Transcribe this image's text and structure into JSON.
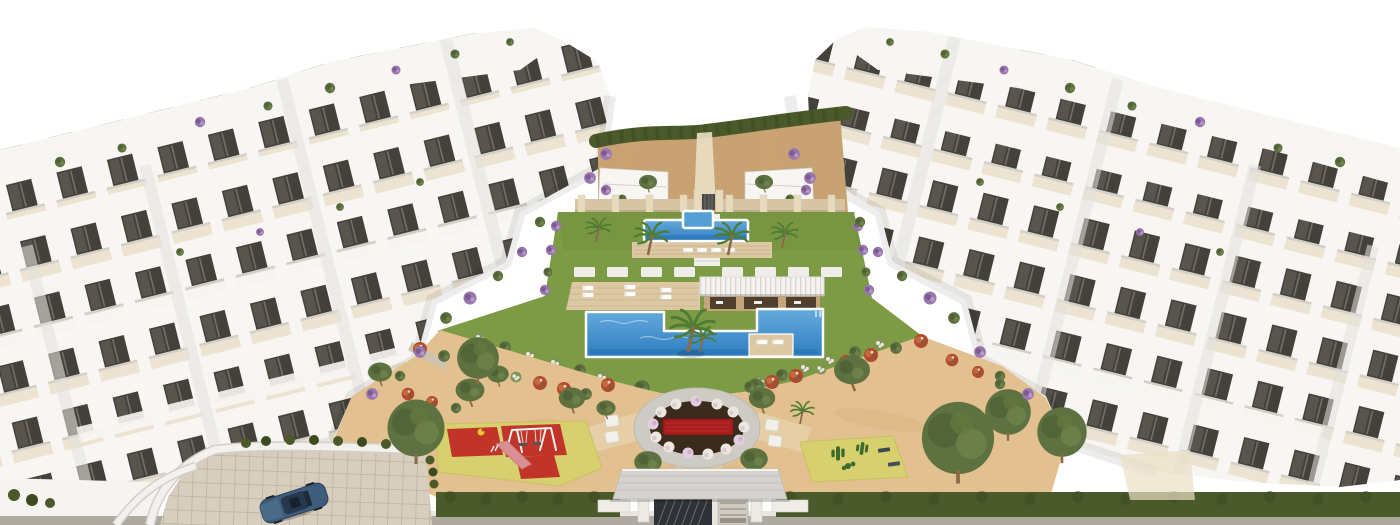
{
  "scene": {
    "setting": "aerial 3D render of a white modern apartment complex around a landscaped central courtyard",
    "features": [
      "left apartment building cluster with terraces and dark glass windows",
      "right apartment building cluster with terraces and dark glass windows",
      "dirt slope with dark hedge between the top blocks",
      "stone wall with pillars and small gate",
      "upper lap pool with raised spa pool",
      "wooden sun deck with white sun loungers",
      "stepping stone path across lawn",
      "pergola pavilion with white slatted roof",
      "large main swimming pool with island deck",
      "palm trees",
      "oval flower garden with red flower bed and white bloom ring",
      "white cube garden benches",
      "diagonal red flowering hedges",
      "children playground with red safety mats, swing set and slide",
      "cactus garden court",
      "olive trees",
      "perimeter hedge",
      "entrance gate with grey canopy and dark slatted gates",
      "curved driveway ramp with paved surface",
      "parked dark blue car"
    ]
  },
  "palette": {
    "sky": "#ffffff",
    "bldg": "#f7f6f3",
    "bldgshade": "#e3e1dc",
    "bldgedge": "#d2cfc9",
    "terrace": "#ece3d1",
    "win": "#44403a",
    "winlight": "#6a655d",
    "lawn": "#7d9a44",
    "lawndeep": "#6a8639",
    "hedge": "#4b5a2a",
    "hedgedeep": "#3e4b22",
    "sand": "#e2c08f",
    "sanddeep": "#cfa671",
    "dirt": "#c9a273",
    "pathlight": "#eadfc4",
    "stone": "#d6c4a2",
    "stonelight": "#e8dabb",
    "deck": "#dcc9a4",
    "deckdeep": "#b89e72",
    "pool": "#2e7cc0",
    "poollight": "#66abdc",
    "pooldeep": "#1f69a8",
    "pergolawall": "#c6a57a",
    "slatroof": "#f4f3ef",
    "offwhite": "#efede8",
    "redbed": "#a81e1e",
    "redmat": "#c0342a",
    "playfloor": "#d7d06f",
    "cactus": "#3f6a2e",
    "olive": "#5e7140",
    "olivedeep": "#4c5d33",
    "palm": "#4e7c33",
    "trunk": "#8a6a48",
    "purple": "#9a76ae",
    "purpledeep": "#7c5a92",
    "orange": "#c06a3e",
    "redorange": "#b14a2e",
    "whiteflower": "#ece7df",
    "ringgray": "#cecbc4",
    "soil": "#3a2b1c",
    "canopy": "#d5d3cf",
    "canopyseam": "#c2c0bb",
    "gate": "#2e3135",
    "gatepanel": "#cfcbc3",
    "road": "#aeaaa2",
    "curb": "#e9e7e2",
    "paver": "#d8cec0",
    "paverline": "#c3b7a4",
    "carbody": "#3e5c7c",
    "cardark": "#26384c"
  }
}
